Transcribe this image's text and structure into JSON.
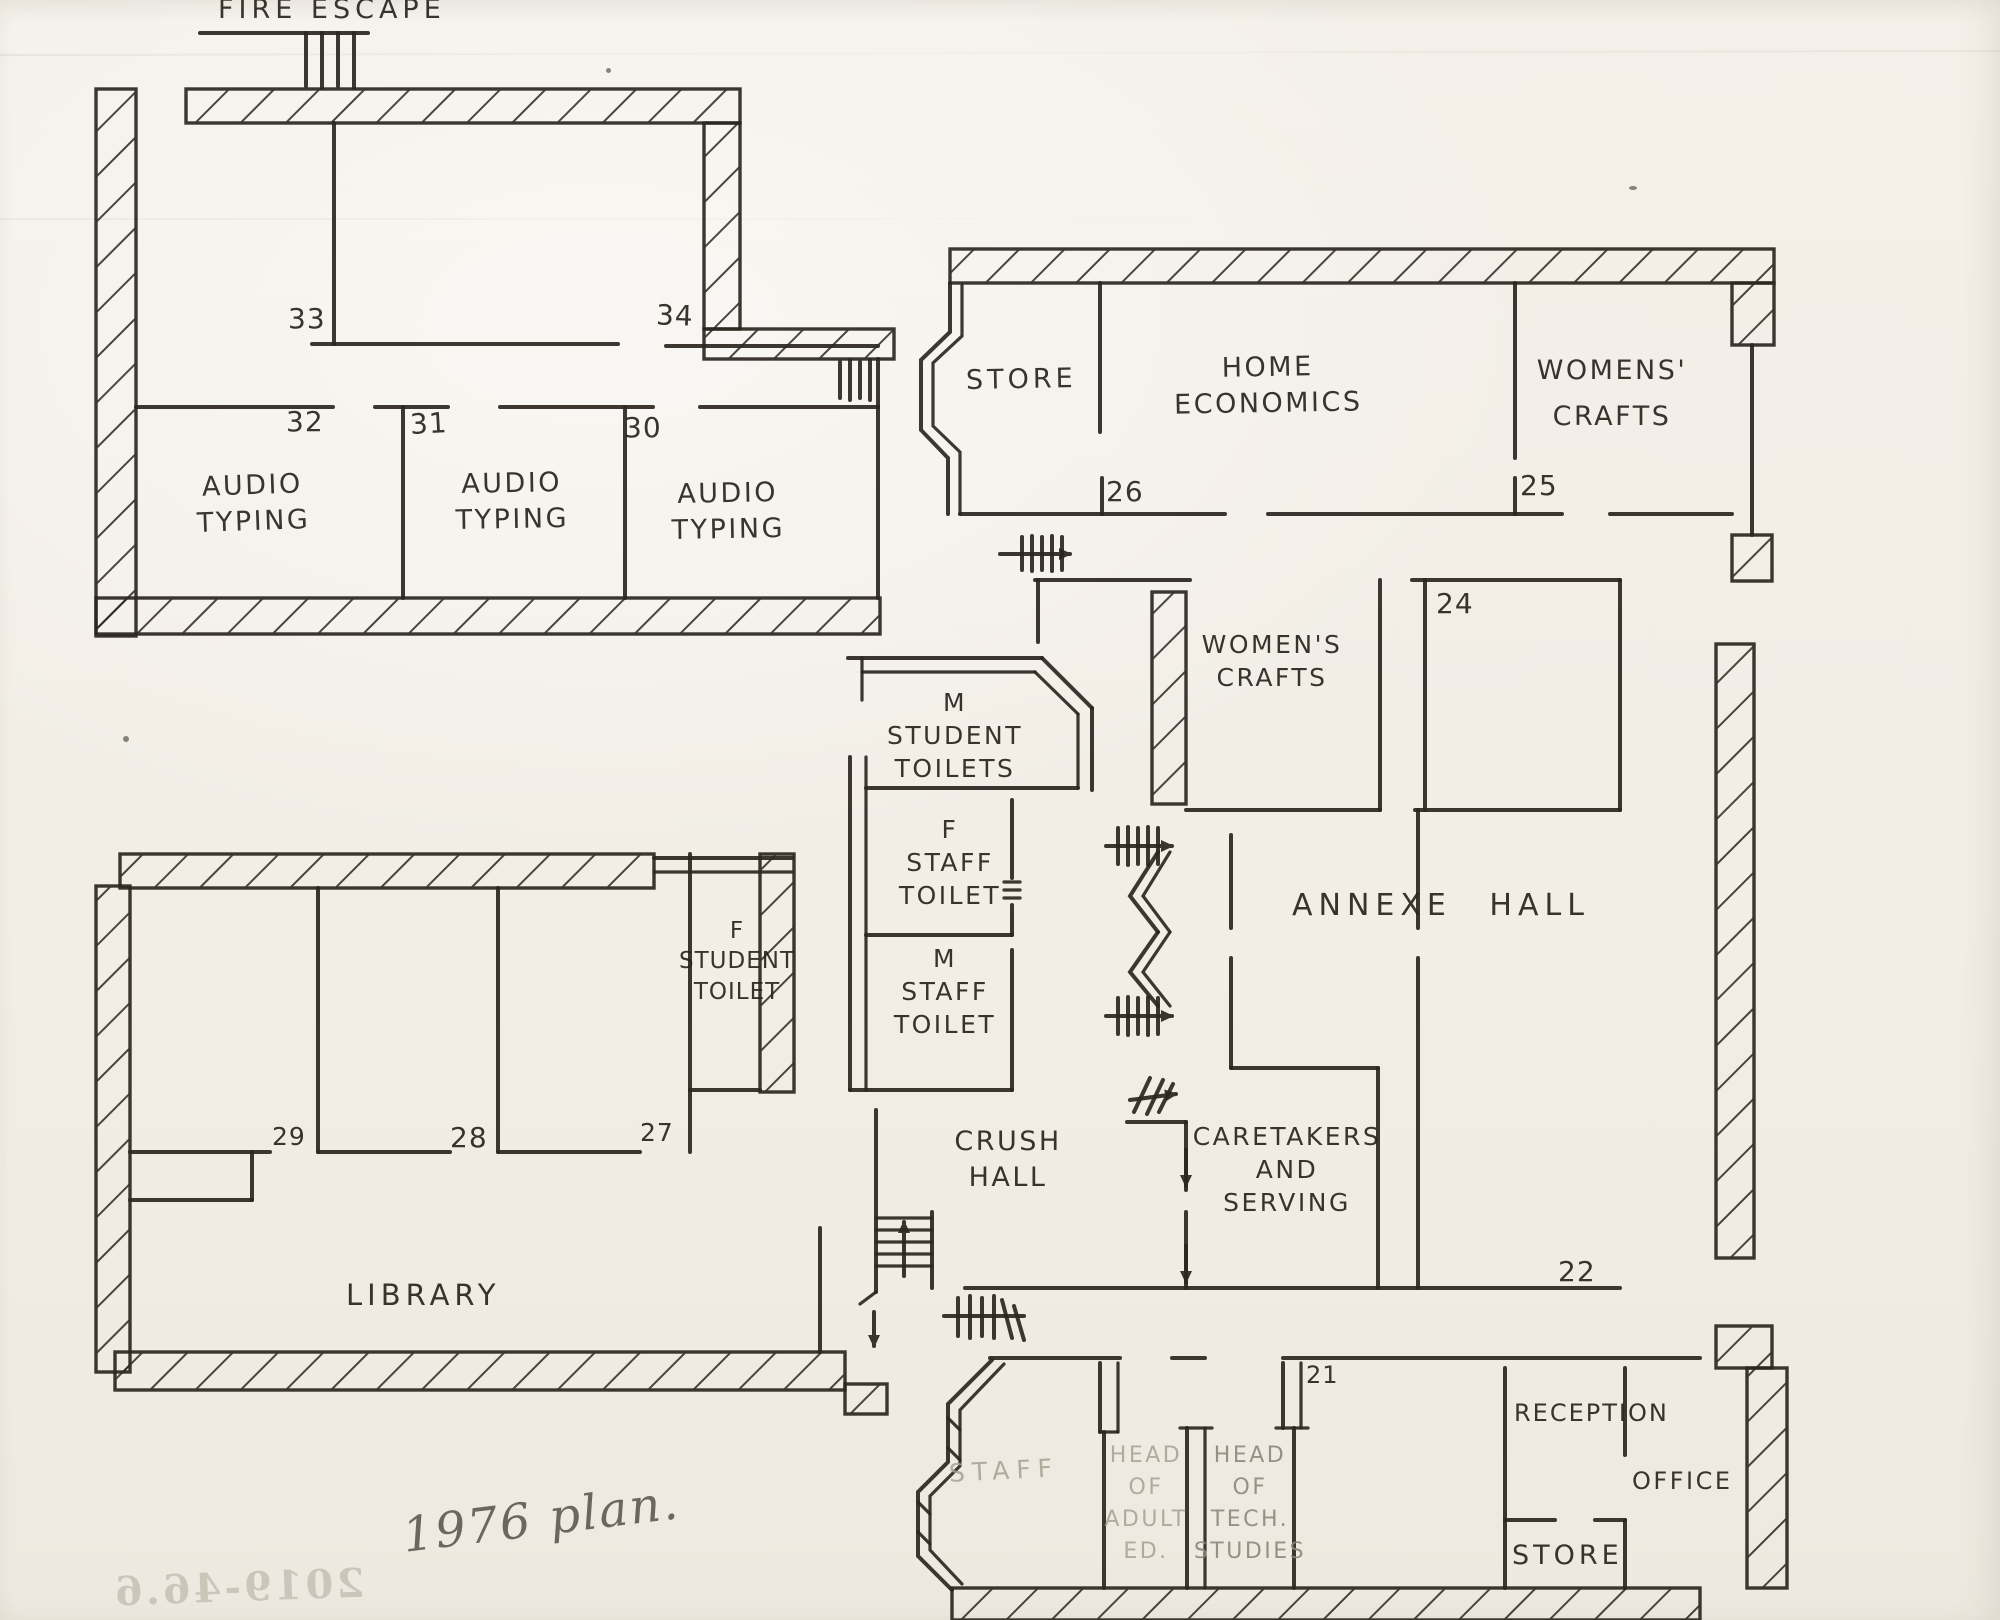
{
  "page": {
    "plan_title": "1976 plan.",
    "bleed_through_text": "2019-46.6"
  },
  "labels": {
    "fire_escape": "FIRE ESCAPE",
    "audio_typing_32": "AUDIO\nTYPING",
    "audio_typing_31": "AUDIO\nTYPING",
    "audio_typing_30": "AUDIO\nTYPING",
    "store_top": "STORE",
    "home_economics": "HOME\nECONOMICS",
    "womens_crafts_top": "WOMENS'\nCRAFTS",
    "womens_crafts_mid": "WOMEN'S\nCRAFTS",
    "annexe_hall": "ANNEXE HALL",
    "m_student_toilets": "M\nSTUDENT\nTOILETS",
    "f_staff_toilet": "F\nSTAFF\nTOILET",
    "m_staff_toilet": "M\nSTAFF\nTOILET",
    "f_student_toilet": "F\nSTUDENT\nTOILET",
    "library": "LIBRARY",
    "crush_hall": "CRUSH\nHALL",
    "caretakers": "CARETAKERS\nAND\nSERVING",
    "staff": "STAFF",
    "head_of_adult_ed": "HEAD\nOF\nADULT\nED.",
    "head_of_tech_studies": "HEAD\nOF\nTECH.\nSTUDIES",
    "reception": "RECEPTION",
    "office": "OFFICE",
    "store_bottom": "STORE"
  },
  "room_numbers": {
    "r33": "33",
    "r34": "34",
    "r32": "32",
    "r31": "31",
    "r30": "30",
    "r26": "26",
    "r25": "25",
    "r24": "24",
    "r29": "29",
    "r28": "28",
    "r27": "27",
    "r22": "22",
    "r21": "21"
  }
}
